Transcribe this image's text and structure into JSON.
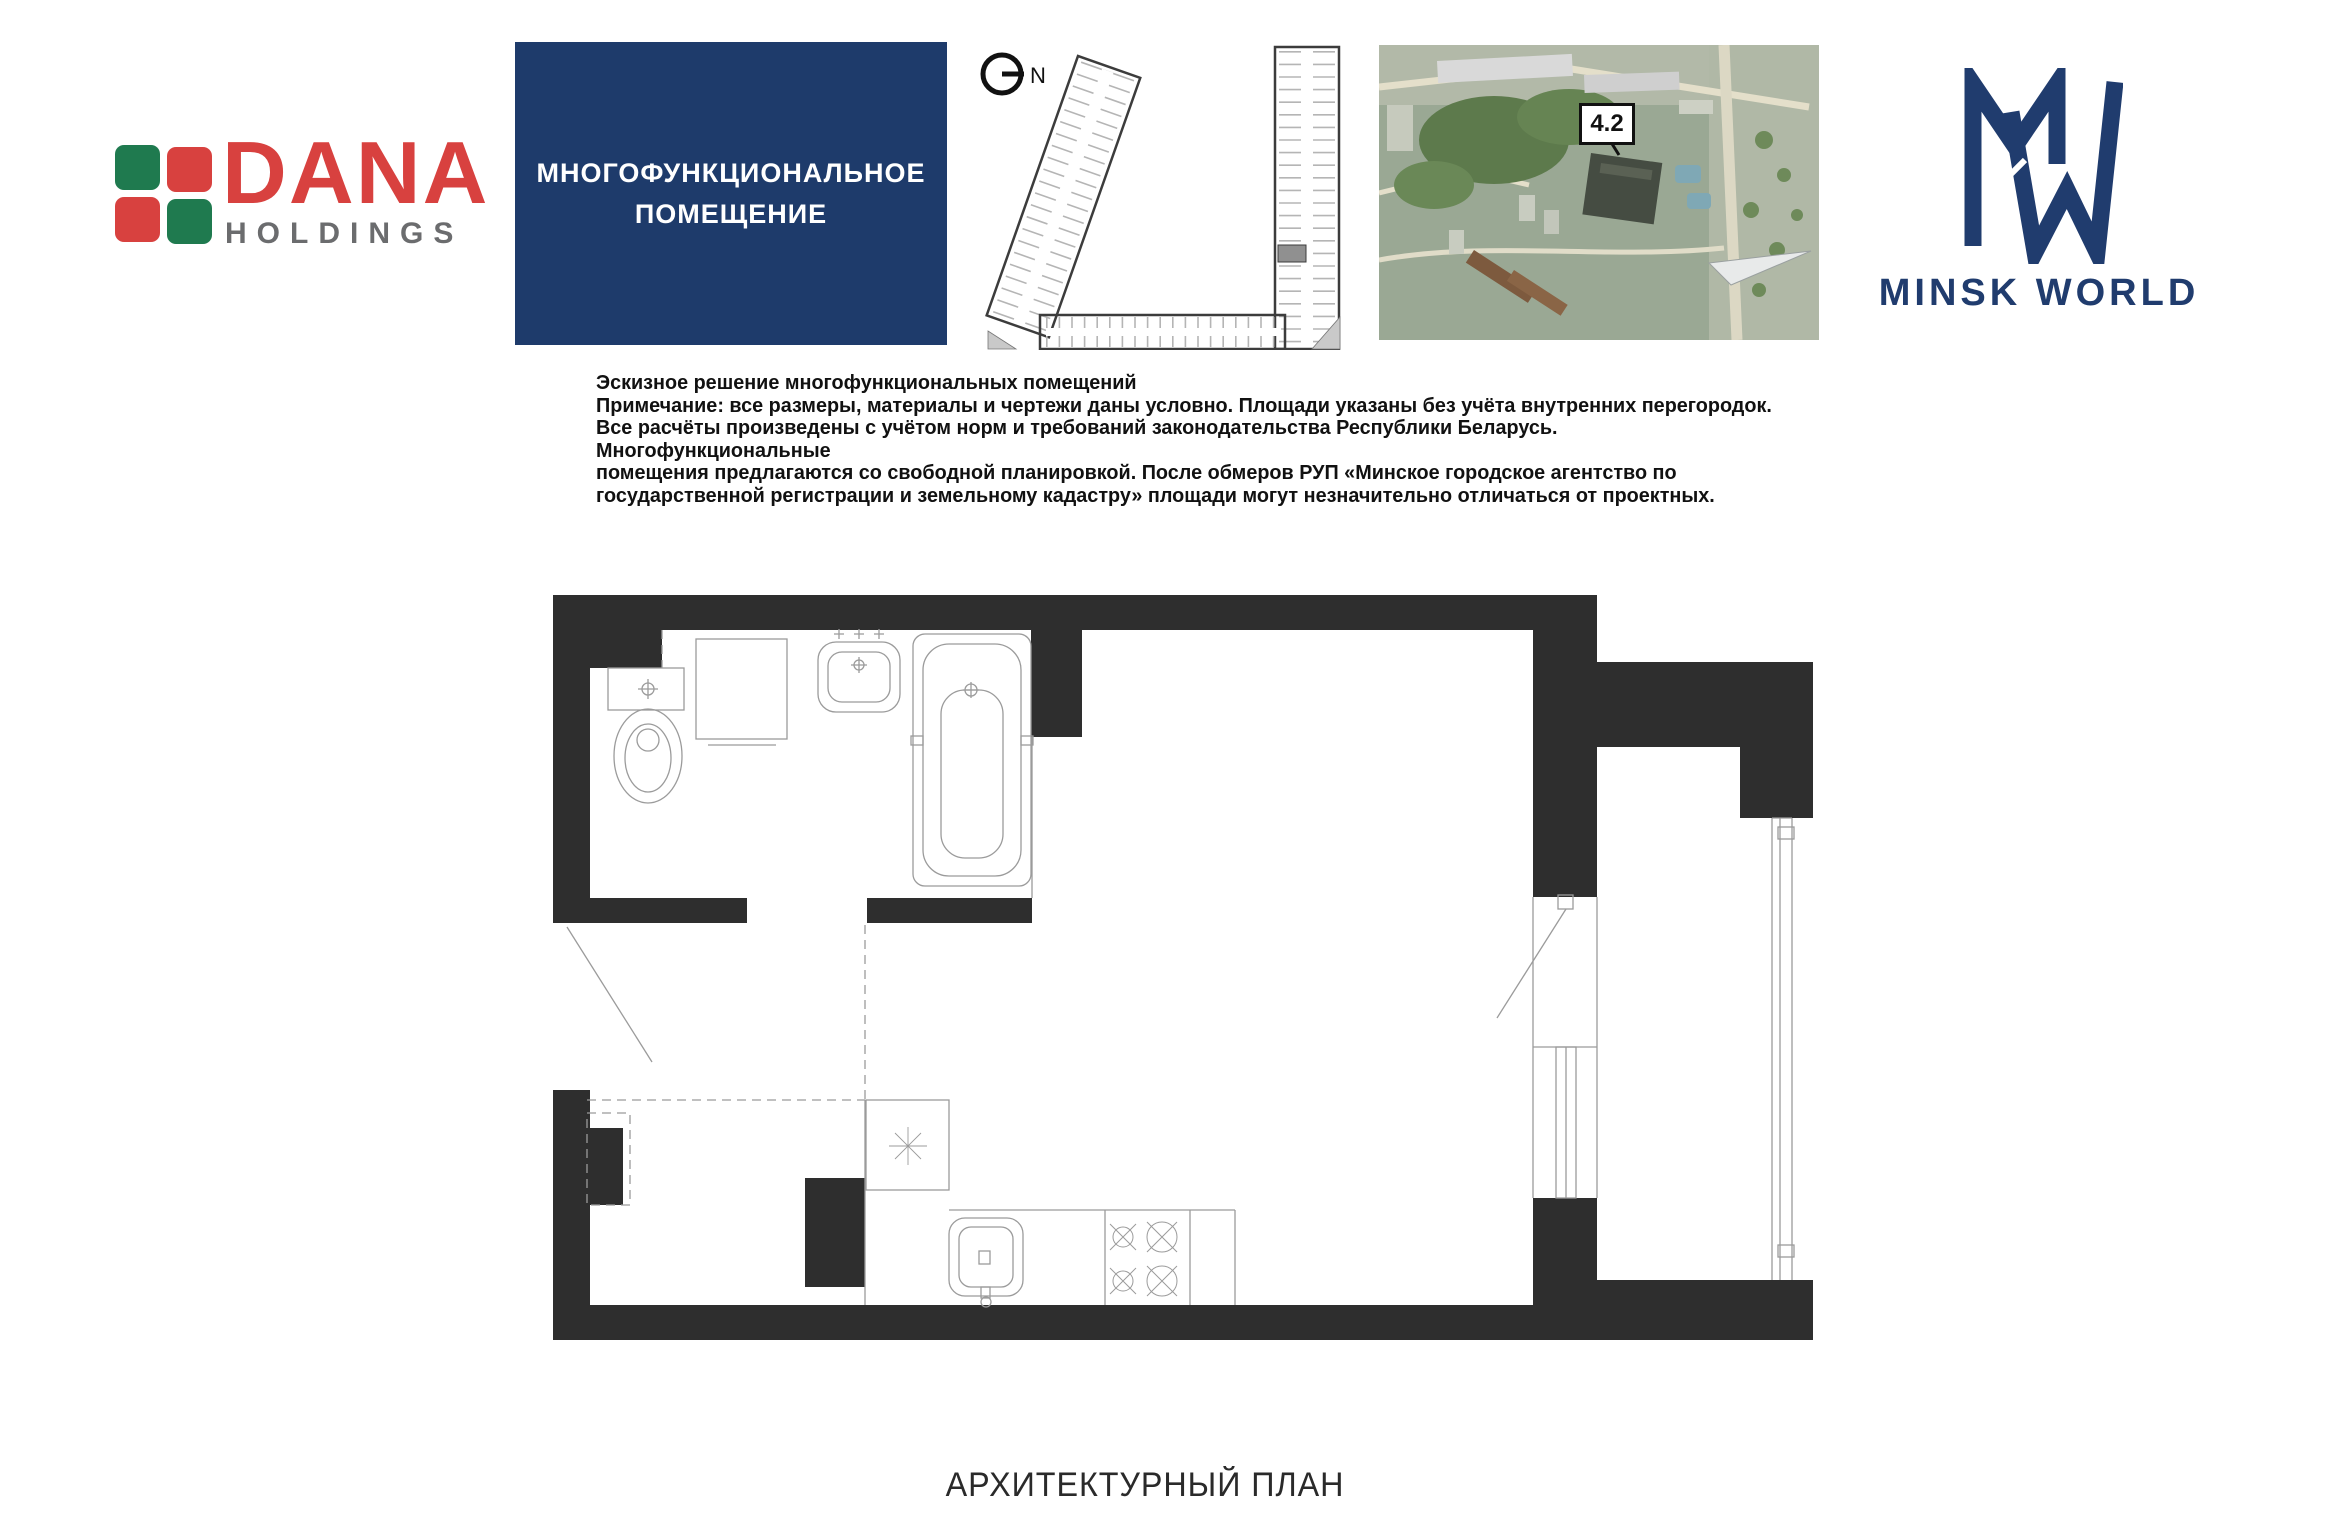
{
  "brand": {
    "name": "DANA",
    "sub": "HOLDINGS",
    "red": "#d8413f",
    "green": "#1f7a4f",
    "gray": "#6b6c6e"
  },
  "title_box": {
    "line1": "МНОГОФУНКЦИОНАЛЬНОЕ",
    "line2": "ПОМЕЩЕНИЕ",
    "bg": "#1e3b6b"
  },
  "site_plan": {
    "north_label": "N",
    "highlight_color": "#909090"
  },
  "aerial": {
    "badge": "4.2"
  },
  "minsk": {
    "wordmark": "MINSK WORLD",
    "navy": "#203c6e"
  },
  "note": {
    "lines": [
      "Эскизное решение многофункциональных помещений",
      "Примечание: все размеры, материалы и чертежи даны условно. Площади указаны без учёта внутренних перегородок.",
      "Все расчёты произведены с учётом норм и требований законодательства Республики Беларусь. Многофункциональные",
      "помещения предлагаются со свободной планировкой. После обмеров РУП «Минское городское агентство по",
      "государственной регистрации и земельному кадастру» площади могут незначительно отличаться от проектных."
    ]
  },
  "floor_plan": {
    "wall_color": "#2e2e2e",
    "line_color": "#9b9b9b"
  },
  "footer": {
    "caption": "АРХИТЕКТУРНЫЙ ПЛАН"
  }
}
